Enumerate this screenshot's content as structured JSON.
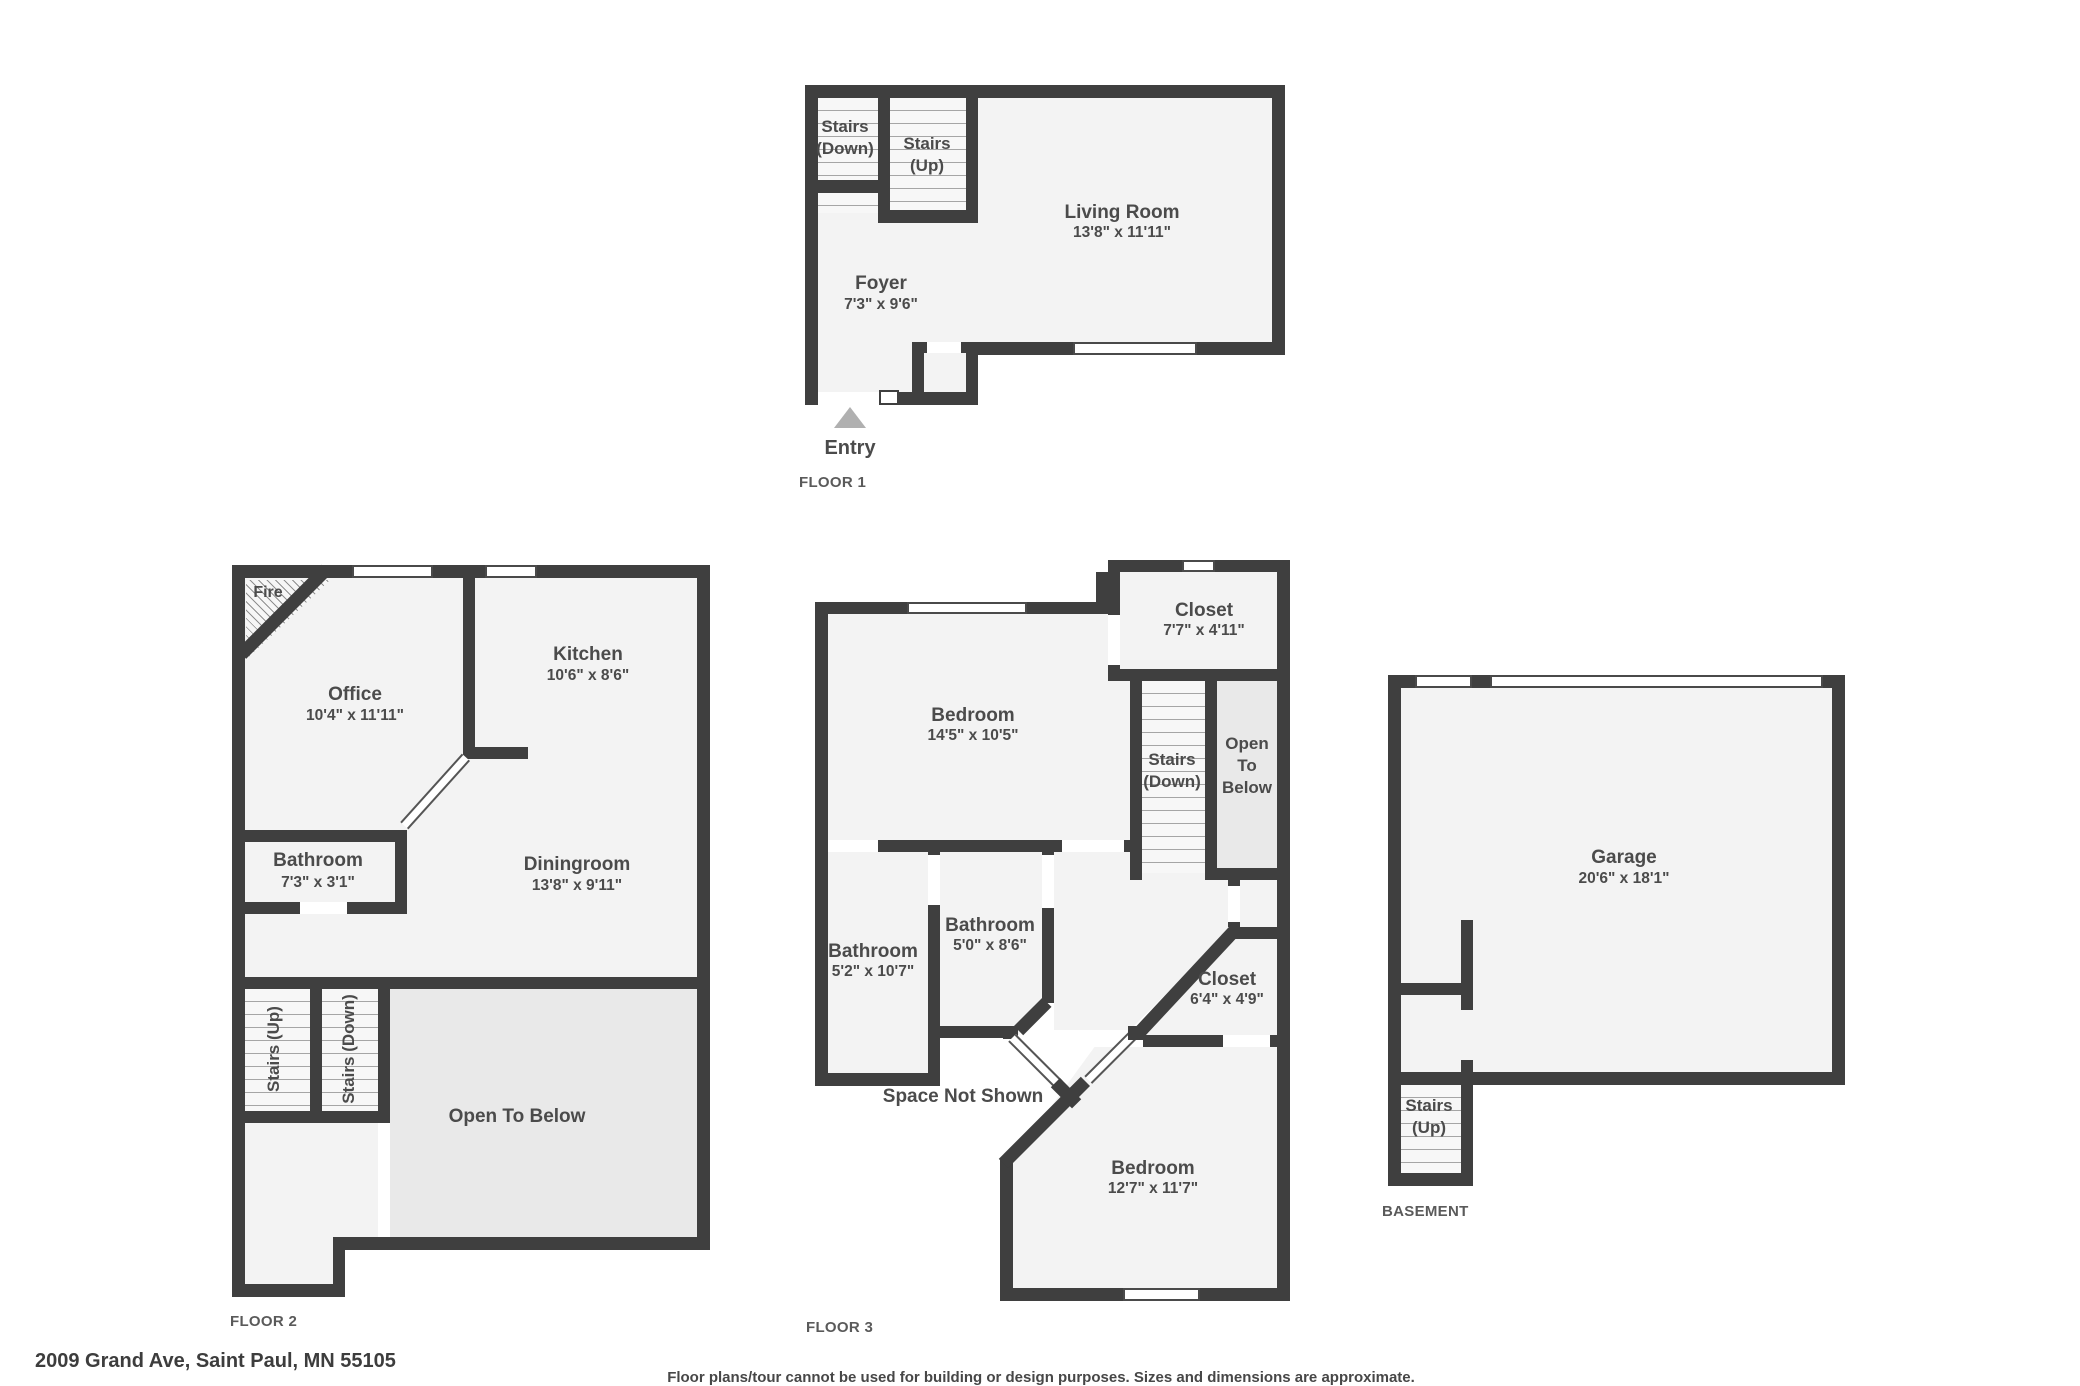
{
  "address": "2009 Grand Ave, Saint Paul, MN 55105",
  "disclaimer": "Floor plans/tour cannot be used for building or design purposes. Sizes and dimensions are approximate.",
  "colors": {
    "wall": "#3f3f3f",
    "floor": "#f3f3f3",
    "open_to_below": "#e9e9e9",
    "entry_arrow": "#b0b0b0"
  },
  "floor1": {
    "label": "FLOOR 1",
    "entry": "Entry",
    "stairs_down": {
      "l1": "Stairs",
      "l2": "(Down)"
    },
    "stairs_up": {
      "l1": "Stairs",
      "l2": "(Up)"
    },
    "living": {
      "name": "Living Room",
      "dims": "13'8\" x 11'11\""
    },
    "foyer": {
      "name": "Foyer",
      "dims": "7'3\" x 9'6\""
    }
  },
  "floor2": {
    "label": "FLOOR 2",
    "fire": "Fire",
    "office": {
      "name": "Office",
      "dims": "10'4\" x 11'11\""
    },
    "kitchen": {
      "name": "Kitchen",
      "dims": "10'6\" x 8'6\""
    },
    "bathroom": {
      "name": "Bathroom",
      "dims": "7'3\" x 3'1\""
    },
    "dining": {
      "name": "Diningroom",
      "dims": "13'8\" x 9'11\""
    },
    "stairs_up": "Stairs (Up)",
    "stairs_down": "Stairs (Down)",
    "open_below": "Open To Below"
  },
  "floor3": {
    "label": "FLOOR 3",
    "bedroom_top": {
      "name": "Bedroom",
      "dims": "14'5\" x 10'5\""
    },
    "closet_top": {
      "name": "Closet",
      "dims": "7'7\" x 4'11\""
    },
    "stairs_down": {
      "l1": "Stairs",
      "l2": "(Down)"
    },
    "open_below": {
      "l1": "Open",
      "l2": "To",
      "l3": "Below"
    },
    "bathroom_left": {
      "name": "Bathroom",
      "dims": "5'2\" x 10'7\""
    },
    "bathroom_mid": {
      "name": "Bathroom",
      "dims": "5'0\" x 8'6\""
    },
    "closet_right": {
      "name": "Closet",
      "dims": "6'4\" x 4'9\""
    },
    "space_not_shown": "Space Not Shown",
    "bedroom_bottom": {
      "name": "Bedroom",
      "dims": "12'7\" x 11'7\""
    }
  },
  "basement": {
    "label": "BASEMENT",
    "garage": {
      "name": "Garage",
      "dims": "20'6\" x 18'1\""
    },
    "stairs_up": {
      "l1": "Stairs",
      "l2": "(Up)"
    }
  }
}
